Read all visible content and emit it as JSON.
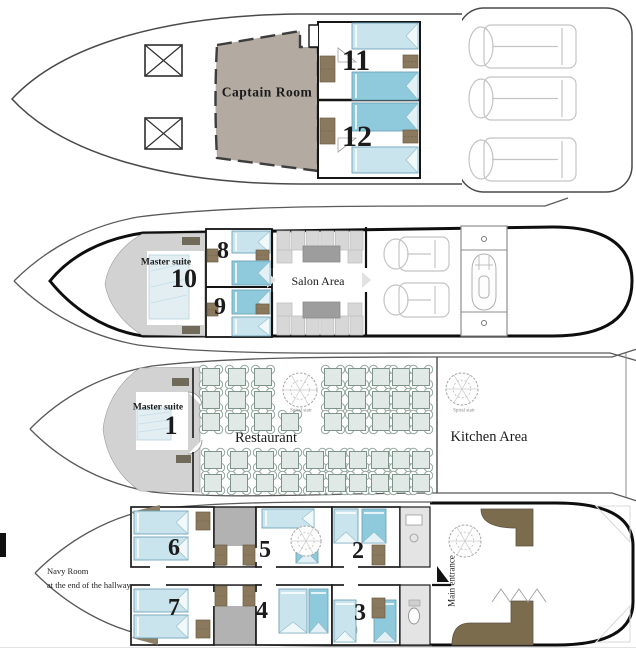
{
  "colors": {
    "bed_light": "#cae4ee",
    "bed_medium": "#8fc9dc",
    "captain_fill": "#b3aba1",
    "furniture_brown": "#8a795c",
    "sofa_brown": "#7b6c4e",
    "area_gray": "#d2d2d2",
    "stair_block_gray": "#b2b2b2",
    "table_fill": "#e0e9e5",
    "hull_line": "#4a4a4a"
  },
  "decks": {
    "sun_deck": {
      "captain_room": "Captain Room",
      "cabin_11": "11",
      "cabin_12": "12"
    },
    "upper_deck": {
      "master_suite": "Master suite",
      "cabin_10": "10",
      "cabin_8": "8",
      "cabin_9": "9",
      "salon": "Salon Area"
    },
    "main_deck": {
      "master_suite": "Master suite",
      "cabin_1": "1",
      "restaurant": "Restaurant",
      "kitchen": "Kitchen Area",
      "spiral_stair_left": "Spiral stair",
      "spiral_stair_right": "Spiral stair"
    },
    "lower_deck": {
      "navy_room_line1": "Navy Room",
      "navy_room_line2": "at the end of the hallway",
      "cabin_6": "6",
      "cabin_7": "7",
      "cabin_5": "5",
      "cabin_4": "4",
      "cabin_2": "2",
      "cabin_3": "3",
      "main_entrance": "Main entrance"
    }
  }
}
